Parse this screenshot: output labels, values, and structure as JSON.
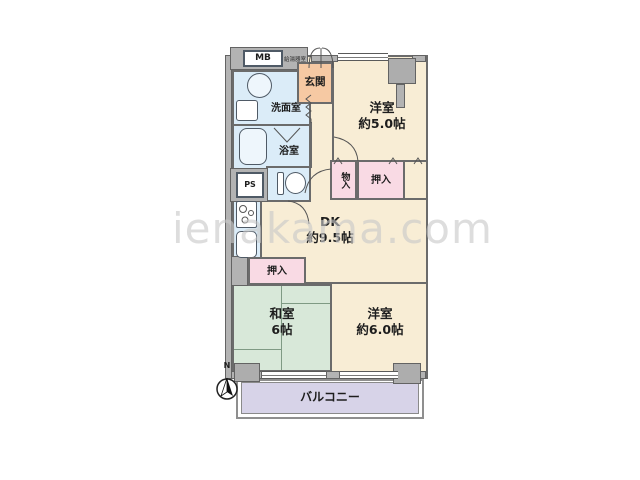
{
  "watermark": "ienakama.com",
  "compass": {
    "label": "N"
  },
  "rooms": {
    "western5": {
      "name": "洋室",
      "size": "約5.0帖"
    },
    "dk": {
      "name": "DK",
      "size": "約9.5帖"
    },
    "japanese": {
      "name": "和室",
      "size": "6帖"
    },
    "western6": {
      "name": "洋室",
      "size": "約6.0帖"
    },
    "balcony": {
      "name": "バルコニー"
    },
    "entrance": {
      "name": "玄関"
    },
    "washroom": {
      "name": "洗面室"
    },
    "bathroom": {
      "name": "浴室"
    },
    "closet_upper": {
      "name": "押入"
    },
    "closet_left": {
      "name": "押入"
    },
    "storage": {
      "name": "物入"
    },
    "pipe_space": {
      "name": "PS"
    },
    "meter_box": {
      "name": "MB"
    },
    "water_heater": {
      "name": "給湯器室"
    }
  },
  "colors": {
    "room_cream": "#F8EDD5",
    "tatami_green": "#D8E8D9",
    "balcony_lavender": "#D7D3E8",
    "entrance_peach": "#F6C9A3",
    "wet_blue": "#DBECF8",
    "closet_pink": "#F9DAE4",
    "wall_gray": "#B3B3B3"
  }
}
